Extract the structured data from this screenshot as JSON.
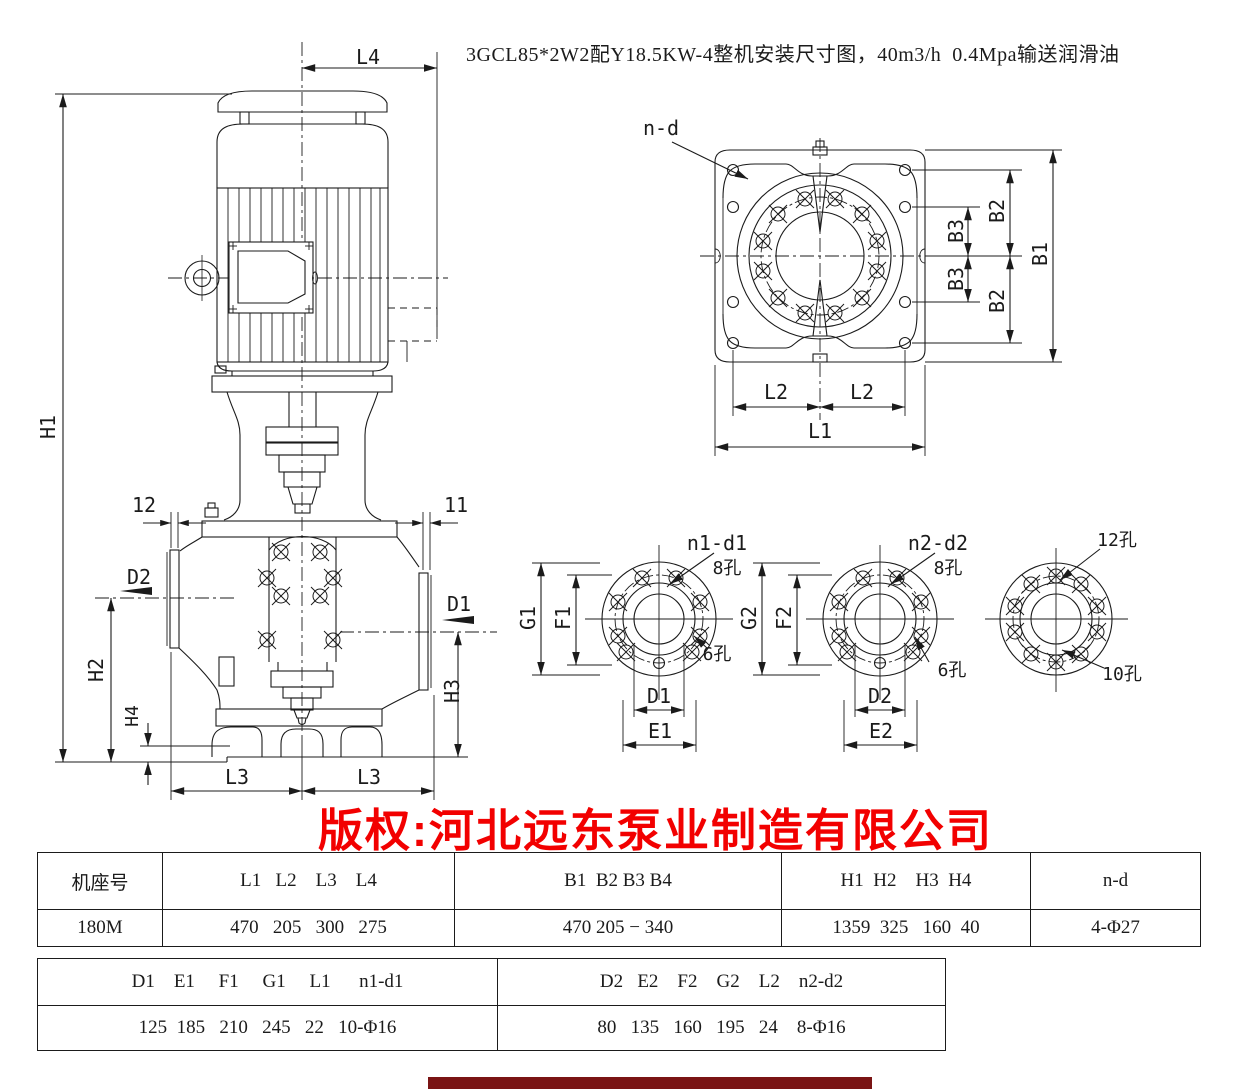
{
  "title": "3GCL85*2W2配Y18.5KW-4整机安装尺寸图，40m3/h  0.4Mpa输送润滑油",
  "watermark": "版权:河北远东泵业制造有限公司",
  "colors": {
    "line": "#1b1b1b",
    "watermark": "#f20000",
    "background": "#ffffff",
    "bottom_bar": "#7a1414"
  },
  "labels": {
    "main_view": {
      "l4": "L4",
      "h1": "H1",
      "t_left": "12",
      "t_right": "11",
      "d2": "D2",
      "d1": "D1",
      "h2": "H2",
      "h4": "H4",
      "h3": "H3",
      "l3_left": "L3",
      "l3_right": "L3"
    },
    "plate_view": {
      "nd": "n-d",
      "b2_top": "B2",
      "b3_top": "B3",
      "b3_bot": "B3",
      "b2_bot": "B2",
      "b1": "B1",
      "l2_left": "L2",
      "l2_right": "L2",
      "l1": "L1"
    },
    "flange1": {
      "callout": "n1-d1",
      "h8": "8孔",
      "h6": "6孔",
      "g": "G1",
      "f": "F1",
      "d": "D1",
      "e": "E1"
    },
    "flange2": {
      "callout": "n2-d2",
      "h8": "8孔",
      "h6": "6孔",
      "g": "G2",
      "f": "F2",
      "d": "D2",
      "e": "E2"
    },
    "flange3": {
      "h12": "12孔",
      "h10": "10孔"
    }
  },
  "table1": {
    "headers": [
      "机座号",
      "L1   L2    L3    L4",
      "B1  B2 B3 B4",
      "H1  H2    H3  H4",
      "n-d"
    ],
    "rows": [
      [
        "180M",
        "470   205   300   275",
        "470 205 − 340",
        "1359  325   160  40",
        "4-Φ27"
      ]
    ]
  },
  "table2": {
    "headers": [
      "D1    E1     F1     G1     L1      n1-d1",
      "D2   E2    F2    G2    L2    n2-d2"
    ],
    "rows": [
      [
        "125  185   210   245   22   10-Φ16",
        "80   135   160   195   24    8-Φ16"
      ]
    ]
  }
}
